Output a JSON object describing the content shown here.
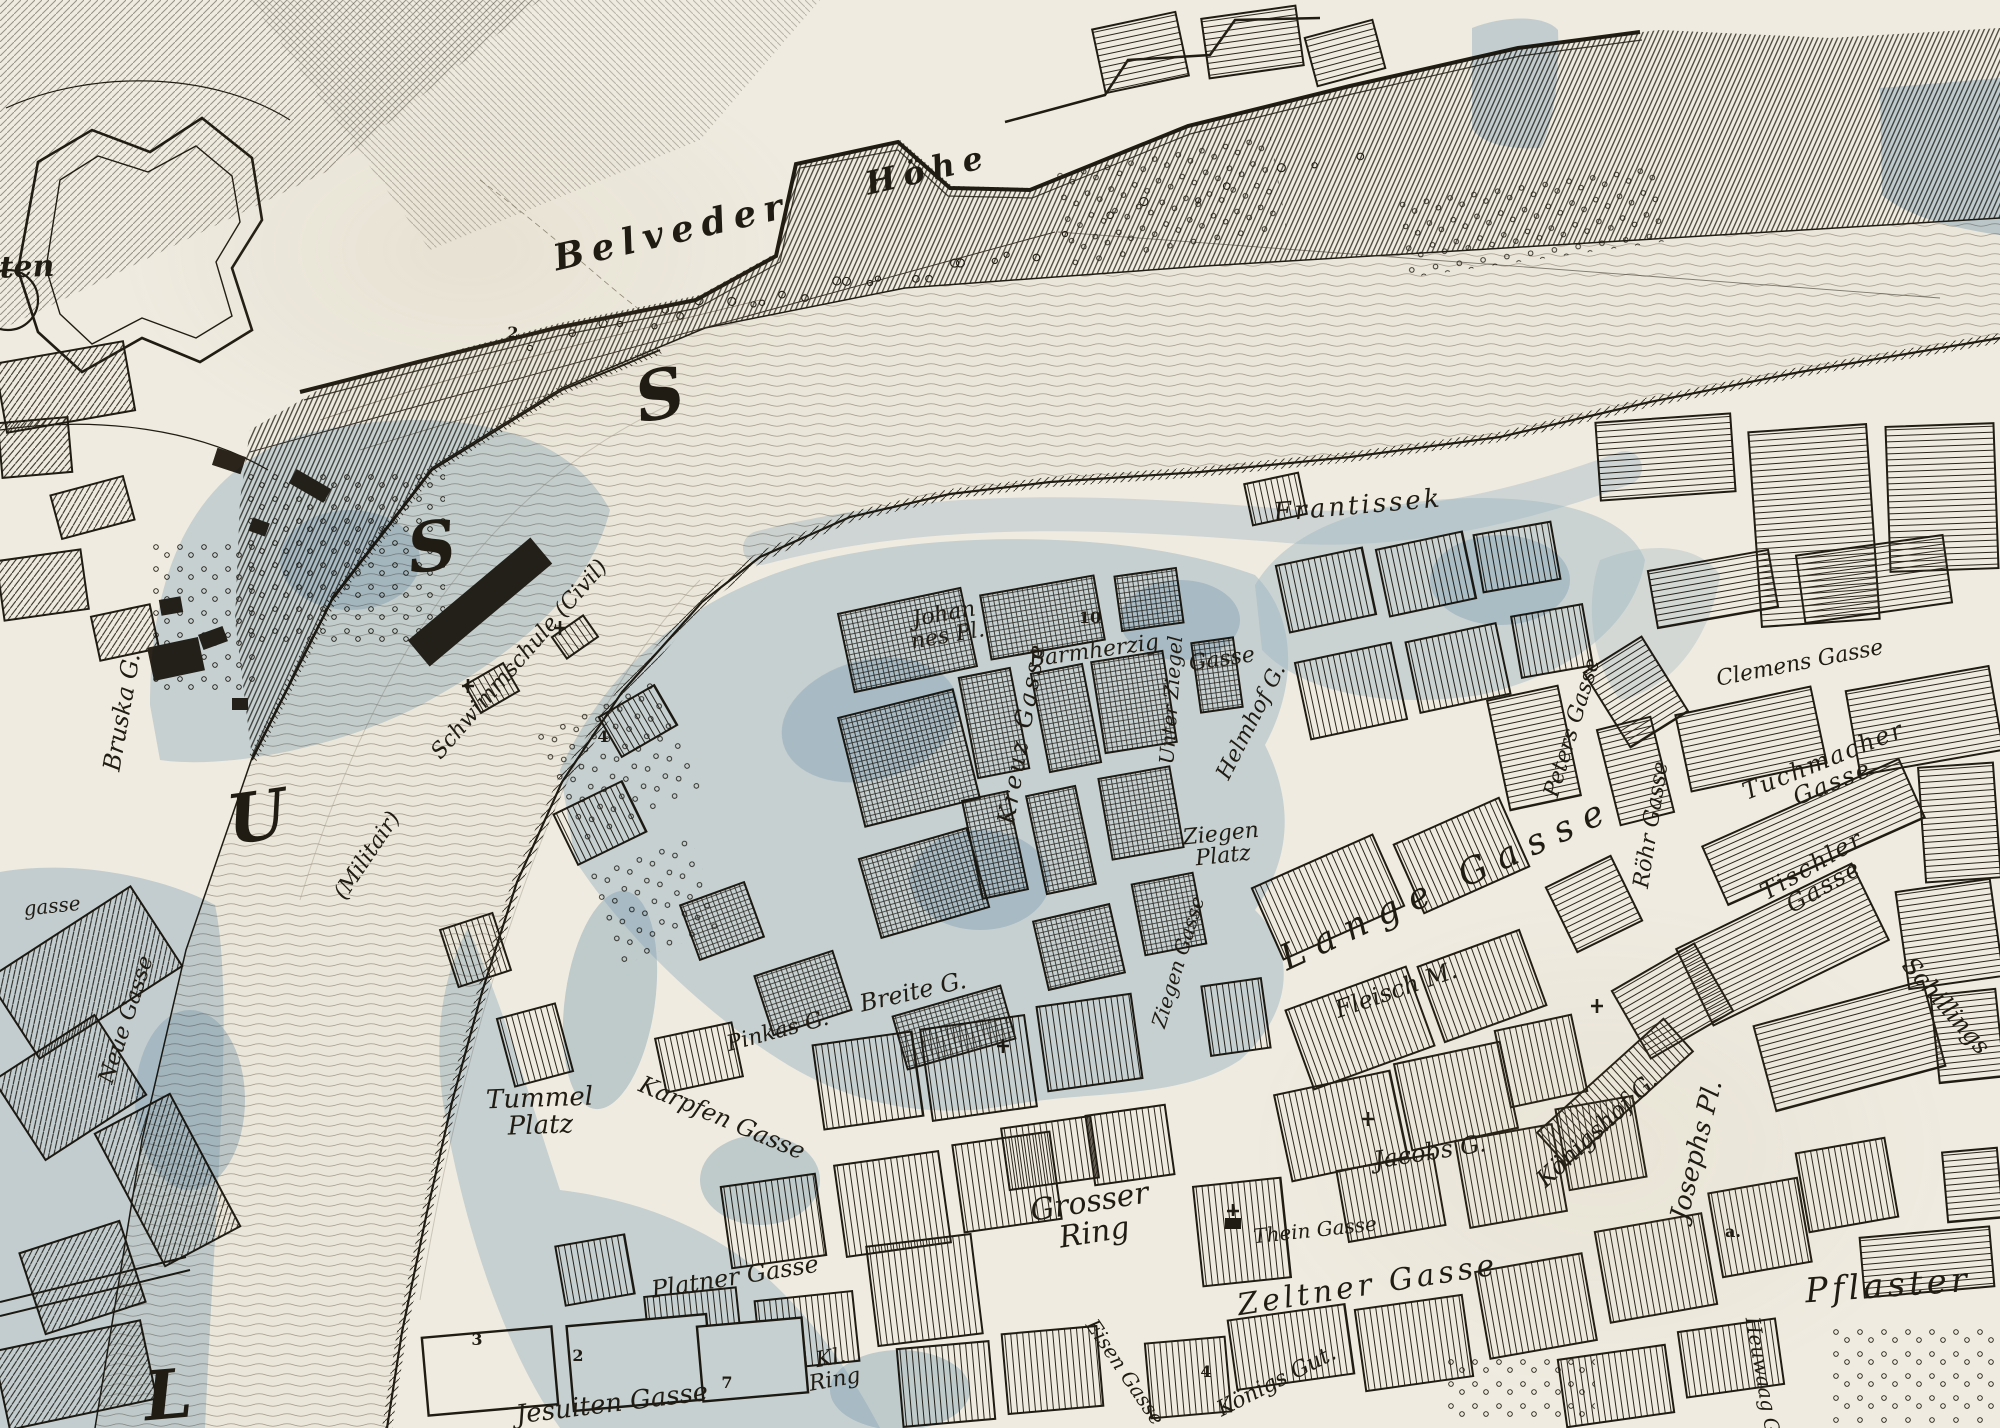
{
  "map": {
    "colors": {
      "paper": "#efebe0",
      "ink": "#211c13",
      "water_wash": "#a9c5dd",
      "water_wash_deep": "#86a9c9",
      "flow_line": "#9a9183"
    },
    "river_letters": [
      {
        "text": "S",
        "x": 660,
        "y": 396,
        "rot": -12
      },
      {
        "text": "S",
        "x": 432,
        "y": 548,
        "rot": -8
      },
      {
        "text": "U",
        "x": 257,
        "y": 818,
        "rot": -8
      },
      {
        "text": "L",
        "x": 168,
        "y": 1396,
        "rot": -5
      }
    ],
    "labels": [
      {
        "text": "ten",
        "x": 27,
        "y": 268,
        "rot": -2,
        "size": 30,
        "cls": "bold"
      },
      {
        "text": "Belveder",
        "x": 672,
        "y": 232,
        "rot": -13,
        "size": 36,
        "ls": 8,
        "cls": "bold"
      },
      {
        "text": "Höhe",
        "x": 928,
        "y": 170,
        "rot": -13,
        "size": 32,
        "ls": 8,
        "cls": "bold"
      },
      {
        "text": "Frantissek",
        "x": 1358,
        "y": 506,
        "rot": -5,
        "size": 26,
        "ls": 3
      },
      {
        "text": "Schwimmschule (Civil)",
        "x": 520,
        "y": 660,
        "rot": -49,
        "size": 22
      },
      {
        "text": "(Militair)",
        "x": 368,
        "y": 856,
        "rot": -56,
        "size": 22
      },
      {
        "text": "Bruska G.",
        "x": 122,
        "y": 712,
        "rot": -80,
        "size": 24
      },
      {
        "text": "Neue Gasse",
        "x": 127,
        "y": 1020,
        "rot": -72,
        "size": 22
      },
      {
        "text": "gasse",
        "x": 52,
        "y": 906,
        "rot": -6,
        "size": 20
      },
      {
        "text": "Johan\nnes Pl.",
        "x": 946,
        "y": 626,
        "rot": -10,
        "size": 22
      },
      {
        "text": "Barmherzig",
        "x": 1094,
        "y": 652,
        "rot": -8,
        "size": 22
      },
      {
        "text": "Gasse",
        "x": 1222,
        "y": 660,
        "rot": -8,
        "size": 22
      },
      {
        "text": "Kreuz Gasse",
        "x": 1022,
        "y": 733,
        "rot": -80,
        "size": 24,
        "ls": 3
      },
      {
        "text": "Unter Ziegel",
        "x": 1171,
        "y": 700,
        "rot": -86,
        "size": 20
      },
      {
        "text": "Helmhof G.",
        "x": 1252,
        "y": 722,
        "rot": -63,
        "size": 22
      },
      {
        "text": "Ziegen\nPlatz",
        "x": 1222,
        "y": 846,
        "rot": -6,
        "size": 22
      },
      {
        "text": "Ziegen Gasse",
        "x": 1178,
        "y": 962,
        "rot": -73,
        "size": 20
      },
      {
        "text": "Clemens Gasse",
        "x": 1800,
        "y": 664,
        "rot": -11,
        "size": 22
      },
      {
        "text": "Peters Gasse",
        "x": 1573,
        "y": 728,
        "rot": -73,
        "size": 22
      },
      {
        "text": "Röhr Gasse",
        "x": 1652,
        "y": 825,
        "rot": -81,
        "size": 22
      },
      {
        "text": "Tuchmacher Gasse",
        "x": 1828,
        "y": 772,
        "rot": -22,
        "size": 24,
        "ls": 2
      },
      {
        "text": "Tischler Gasse",
        "x": 1818,
        "y": 876,
        "rot": -30,
        "size": 24,
        "ls": 2
      },
      {
        "text": "Schillings",
        "x": 1946,
        "y": 1006,
        "rot": 49,
        "size": 24
      },
      {
        "text": "Lange Gasse",
        "x": 1448,
        "y": 884,
        "rot": -25,
        "size": 36,
        "ls": 12
      },
      {
        "text": "Fleisch M.",
        "x": 1396,
        "y": 990,
        "rot": -19,
        "size": 24
      },
      {
        "text": "Jacobs G.",
        "x": 1430,
        "y": 1152,
        "rot": -9,
        "size": 24
      },
      {
        "text": "Königshof G.",
        "x": 1597,
        "y": 1130,
        "rot": -43,
        "size": 24
      },
      {
        "text": "Josephs Pl.",
        "x": 1697,
        "y": 1150,
        "rot": -76,
        "size": 26
      },
      {
        "text": "Grosser\nRing",
        "x": 1092,
        "y": 1218,
        "rot": -9,
        "size": 30
      },
      {
        "text": "Thein Gasse",
        "x": 1315,
        "y": 1230,
        "rot": -6,
        "size": 20
      },
      {
        "text": "Zeltner Gasse",
        "x": 1368,
        "y": 1286,
        "rot": -9,
        "size": 30,
        "ls": 4
      },
      {
        "text": "Pflaster",
        "x": 1888,
        "y": 1286,
        "rot": -4,
        "size": 34,
        "ls": 4
      },
      {
        "text": "Tummel\nPlatz",
        "x": 540,
        "y": 1112,
        "rot": -2,
        "size": 26
      },
      {
        "text": "Karpfen Gasse",
        "x": 722,
        "y": 1118,
        "rot": 23,
        "size": 24
      },
      {
        "text": "Pinkas G.",
        "x": 778,
        "y": 1032,
        "rot": -15,
        "size": 22
      },
      {
        "text": "Breite G.",
        "x": 913,
        "y": 992,
        "rot": -13,
        "size": 24
      },
      {
        "text": "Platner Gasse",
        "x": 735,
        "y": 1277,
        "rot": -9,
        "size": 24
      },
      {
        "text": "Jesuiten Gasse",
        "x": 612,
        "y": 1404,
        "rot": -7,
        "size": 26
      },
      {
        "text": "Kl.\nRing",
        "x": 833,
        "y": 1370,
        "rot": -10,
        "size": 22
      },
      {
        "text": "Eisen Gasse",
        "x": 1125,
        "y": 1372,
        "rot": 56,
        "size": 20
      },
      {
        "text": "Königs Gut.",
        "x": 1277,
        "y": 1382,
        "rot": -27,
        "size": 22
      },
      {
        "text": "Heuwaag G.",
        "x": 1763,
        "y": 1378,
        "rot": 80,
        "size": 20
      }
    ],
    "markers": [
      {
        "text": "2",
        "x": 513,
        "y": 333
      },
      {
        "text": "10",
        "x": 1090,
        "y": 618
      },
      {
        "text": "4",
        "x": 603,
        "y": 737
      },
      {
        "text": "3",
        "x": 477,
        "y": 1340
      },
      {
        "text": "2",
        "x": 578,
        "y": 1356
      },
      {
        "text": "7",
        "x": 727,
        "y": 1383
      },
      {
        "text": "4",
        "x": 1206,
        "y": 1372
      },
      {
        "text": "a.",
        "x": 1733,
        "y": 1232
      }
    ]
  }
}
